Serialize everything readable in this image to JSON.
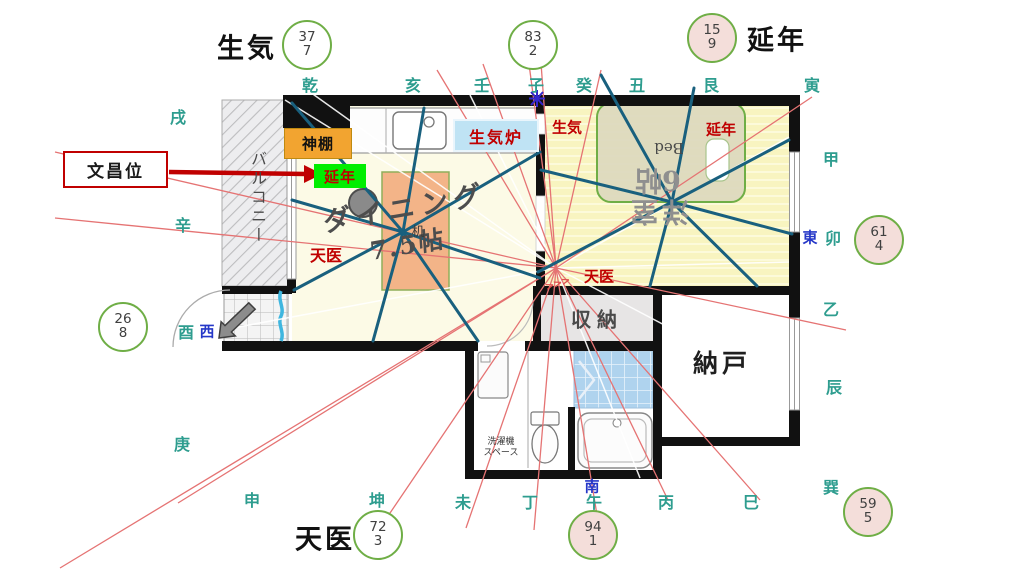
{
  "title": "間取り図 風水方位図",
  "fortune": {
    "top_left": "生気",
    "top_right": "延年",
    "bottom_left": "天医",
    "callout": "文昌位"
  },
  "compass": {
    "top": [
      "乾",
      "亥",
      "壬",
      "子",
      "癸",
      "丑",
      "艮",
      "寅"
    ],
    "right": [
      "甲",
      "卯",
      "乙",
      "辰",
      "巽"
    ],
    "bottom": [
      "巳",
      "丙",
      "午",
      "丁",
      "未",
      "坤",
      "申"
    ],
    "left": [
      "庚",
      "酉",
      "辛",
      "戌"
    ],
    "cardinals": {
      "east": "東",
      "west": "西",
      "south": "南"
    }
  },
  "circles": [
    {
      "value": "377",
      "lines": [
        "37",
        "7"
      ],
      "fill": "white"
    },
    {
      "value": "832",
      "lines": [
        "83",
        "2"
      ],
      "fill": "white"
    },
    {
      "value": "159",
      "lines": [
        "15",
        "9"
      ],
      "fill": "pink"
    },
    {
      "value": "614",
      "lines": [
        "61",
        "4"
      ],
      "fill": "pink"
    },
    {
      "value": "268",
      "lines": [
        "26",
        "8"
      ],
      "fill": "white"
    },
    {
      "value": "723",
      "lines": [
        "72",
        "3"
      ],
      "fill": "white"
    },
    {
      "value": "941",
      "lines": [
        "94",
        "1"
      ],
      "fill": "pink"
    },
    {
      "value": "595",
      "lines": [
        "59",
        "5"
      ],
      "fill": "pink"
    }
  ],
  "rooms": {
    "balcony": "バルコニー",
    "dining": "ダイニング",
    "dining_size": "7.5帖",
    "desk": "机",
    "bed": "Bed",
    "western": "洋室",
    "western_size": "6帖",
    "closet": "収納",
    "storage": "納戸",
    "laundry_line1": "洗濯機",
    "laundry_line2": "スペース"
  },
  "markers": {
    "kamidana": "神棚",
    "ennen_green": "延年",
    "seiki_stove": "生気炉",
    "seiki": "生気",
    "ennen": "延年",
    "tenni_dining": "天医",
    "tenni_center": "天医",
    "chevrons": ">>>"
  },
  "palette": {
    "compass_teal": "#2E9D8F",
    "cardinal_blue": "#2638C8",
    "red_accent": "#C00000",
    "red_line": "#E57373",
    "blue_line": "#19607E",
    "circle_border": "#6FAE46",
    "circle_pink_fill": "#F4DEDA",
    "kamidana_orange": "#F2A430",
    "ennen_green_bg": "#00EE00",
    "stove_blue_bg": "#BFE3F4"
  }
}
